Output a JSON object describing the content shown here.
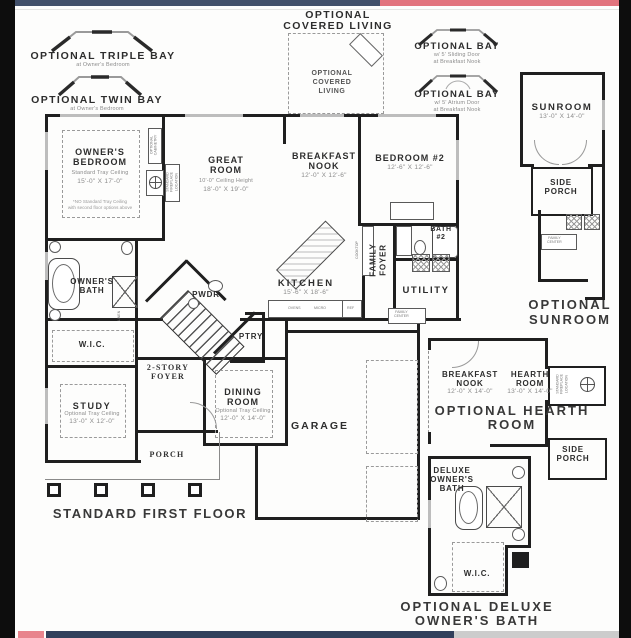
{
  "colors": {
    "edge_black": "#0d0d0d",
    "paper": "#fdfdfc",
    "wall": "#1f1f1f",
    "top_bar_navy": "#42506a",
    "top_bar_red": "#e2737d",
    "bottom_bar_pink": "#e8848d",
    "bottom_bar_navy": "#31405c",
    "bottom_bar_gray": "#cccccc"
  },
  "annotations": {
    "triple_bay": {
      "title": "OPTIONAL TRIPLE BAY",
      "sub": "at Owner's Bedroom"
    },
    "twin_bay": {
      "title": "OPTIONAL TWIN BAY",
      "sub": "at Owner's Bedroom"
    },
    "covered_living": {
      "heading_line1": "OPTIONAL",
      "heading_line2": "COVERED LIVING",
      "inner_line1": "OPTIONAL",
      "inner_line2": "COVERED",
      "inner_line3": "LIVING"
    },
    "bay_sliding": {
      "title": "OPTIONAL BAY",
      "sub1": "w/ 5' Sliding Door",
      "sub2": "at Breakfast Nook"
    },
    "bay_atrium": {
      "title": "OPTIONAL BAY",
      "sub1": "w/ 5' Atrium Door",
      "sub2": "at Breakfast Nook"
    },
    "optional_sunroom": {
      "line1": "OPTIONAL",
      "line2": "SUNROOM"
    },
    "optional_hearth": {
      "line1": "OPTIONAL HEARTH",
      "line2": "ROOM"
    },
    "optional_deluxe": {
      "line1": "OPTIONAL DELUXE",
      "line2": "OWNER'S BATH"
    },
    "floor_label": "STANDARD FIRST FLOOR"
  },
  "rooms": {
    "owners_bedroom": {
      "line1": "OWNER'S",
      "line2": "BEDROOM",
      "sub": "Standard Tray Ceiling",
      "dims": "15'-0\" X 17'-0\"",
      "note1": "*NO Standard Tray Ceiling",
      "note2": "with second floor options above"
    },
    "great_room": {
      "line1": "GREAT",
      "line2": "ROOM",
      "sub": "10'-0\" Ceiling Height",
      "dims": "18'-0\" X 19'-0\""
    },
    "breakfast_nook": {
      "line1": "BREAKFAST",
      "line2": "NOOK",
      "dims": "12'-0\" X 12'-6\""
    },
    "bedroom_2": {
      "name": "BEDROOM #2",
      "dims": "12'-6\" X 12'-6\""
    },
    "bath_2": {
      "line1": "BATH",
      "line2": "#2"
    },
    "family_foyer": {
      "line1": "FAMILY",
      "line2": "FOYER"
    },
    "kitchen": {
      "name": "KITCHEN",
      "dims": "15'-6\" X 18'-6\""
    },
    "utility": {
      "name": "UTILITY"
    },
    "powder": {
      "name": "PWDR"
    },
    "pantry": {
      "name": "PTRY"
    },
    "foyer": {
      "line1": "2-STORY",
      "line2": "FOYER"
    },
    "dining": {
      "line1": "DINING",
      "line2": "ROOM",
      "sub": "Optional Tray Ceiling",
      "dims": "12'-0\" X 14'-0\""
    },
    "study": {
      "name": "STUDY",
      "sub": "Optional Tray Ceiling",
      "dims": "13'-0\" X 12'-0\""
    },
    "garage": {
      "name": "GARAGE"
    },
    "porch": {
      "name": "PORCH"
    },
    "owners_bath": {
      "line1": "OWNER'S",
      "line2": "BATH"
    },
    "wic": {
      "name": "W.I.C."
    },
    "sunroom": {
      "name": "SUNROOM",
      "dims": "13'-0\" X 14'-0\""
    },
    "side_porch_a": {
      "line1": "SIDE",
      "line2": "PORCH"
    },
    "hearth_breakfast_nook": {
      "line1": "BREAKFAST",
      "line2": "NOOK",
      "dims": "12'-0\" X 14'-0\""
    },
    "hearth_room": {
      "line1": "HEARTH",
      "line2": "ROOM",
      "dims": "13'-0\" X 14'-0\""
    },
    "side_porch_b": {
      "line1": "SIDE",
      "line2": "PORCH"
    },
    "deluxe_bath": {
      "line1": "DELUXE",
      "line2": "OWNER'S",
      "line3": "BATH"
    },
    "wic_deluxe": {
      "name": "W.I.C."
    }
  },
  "fixtures": {
    "optional_cabinetry": "OPTIONAL CABINETRY",
    "fireplace_note": "STANDARD FIREPLACE LOCATION",
    "family_center_line1": "FAMILY",
    "family_center_line2": "CENTER",
    "cooktop": "COOKTOP",
    "ovens": "OVENS",
    "micro": "MICRO",
    "ref": "REF",
    "linen": "LINEN"
  }
}
